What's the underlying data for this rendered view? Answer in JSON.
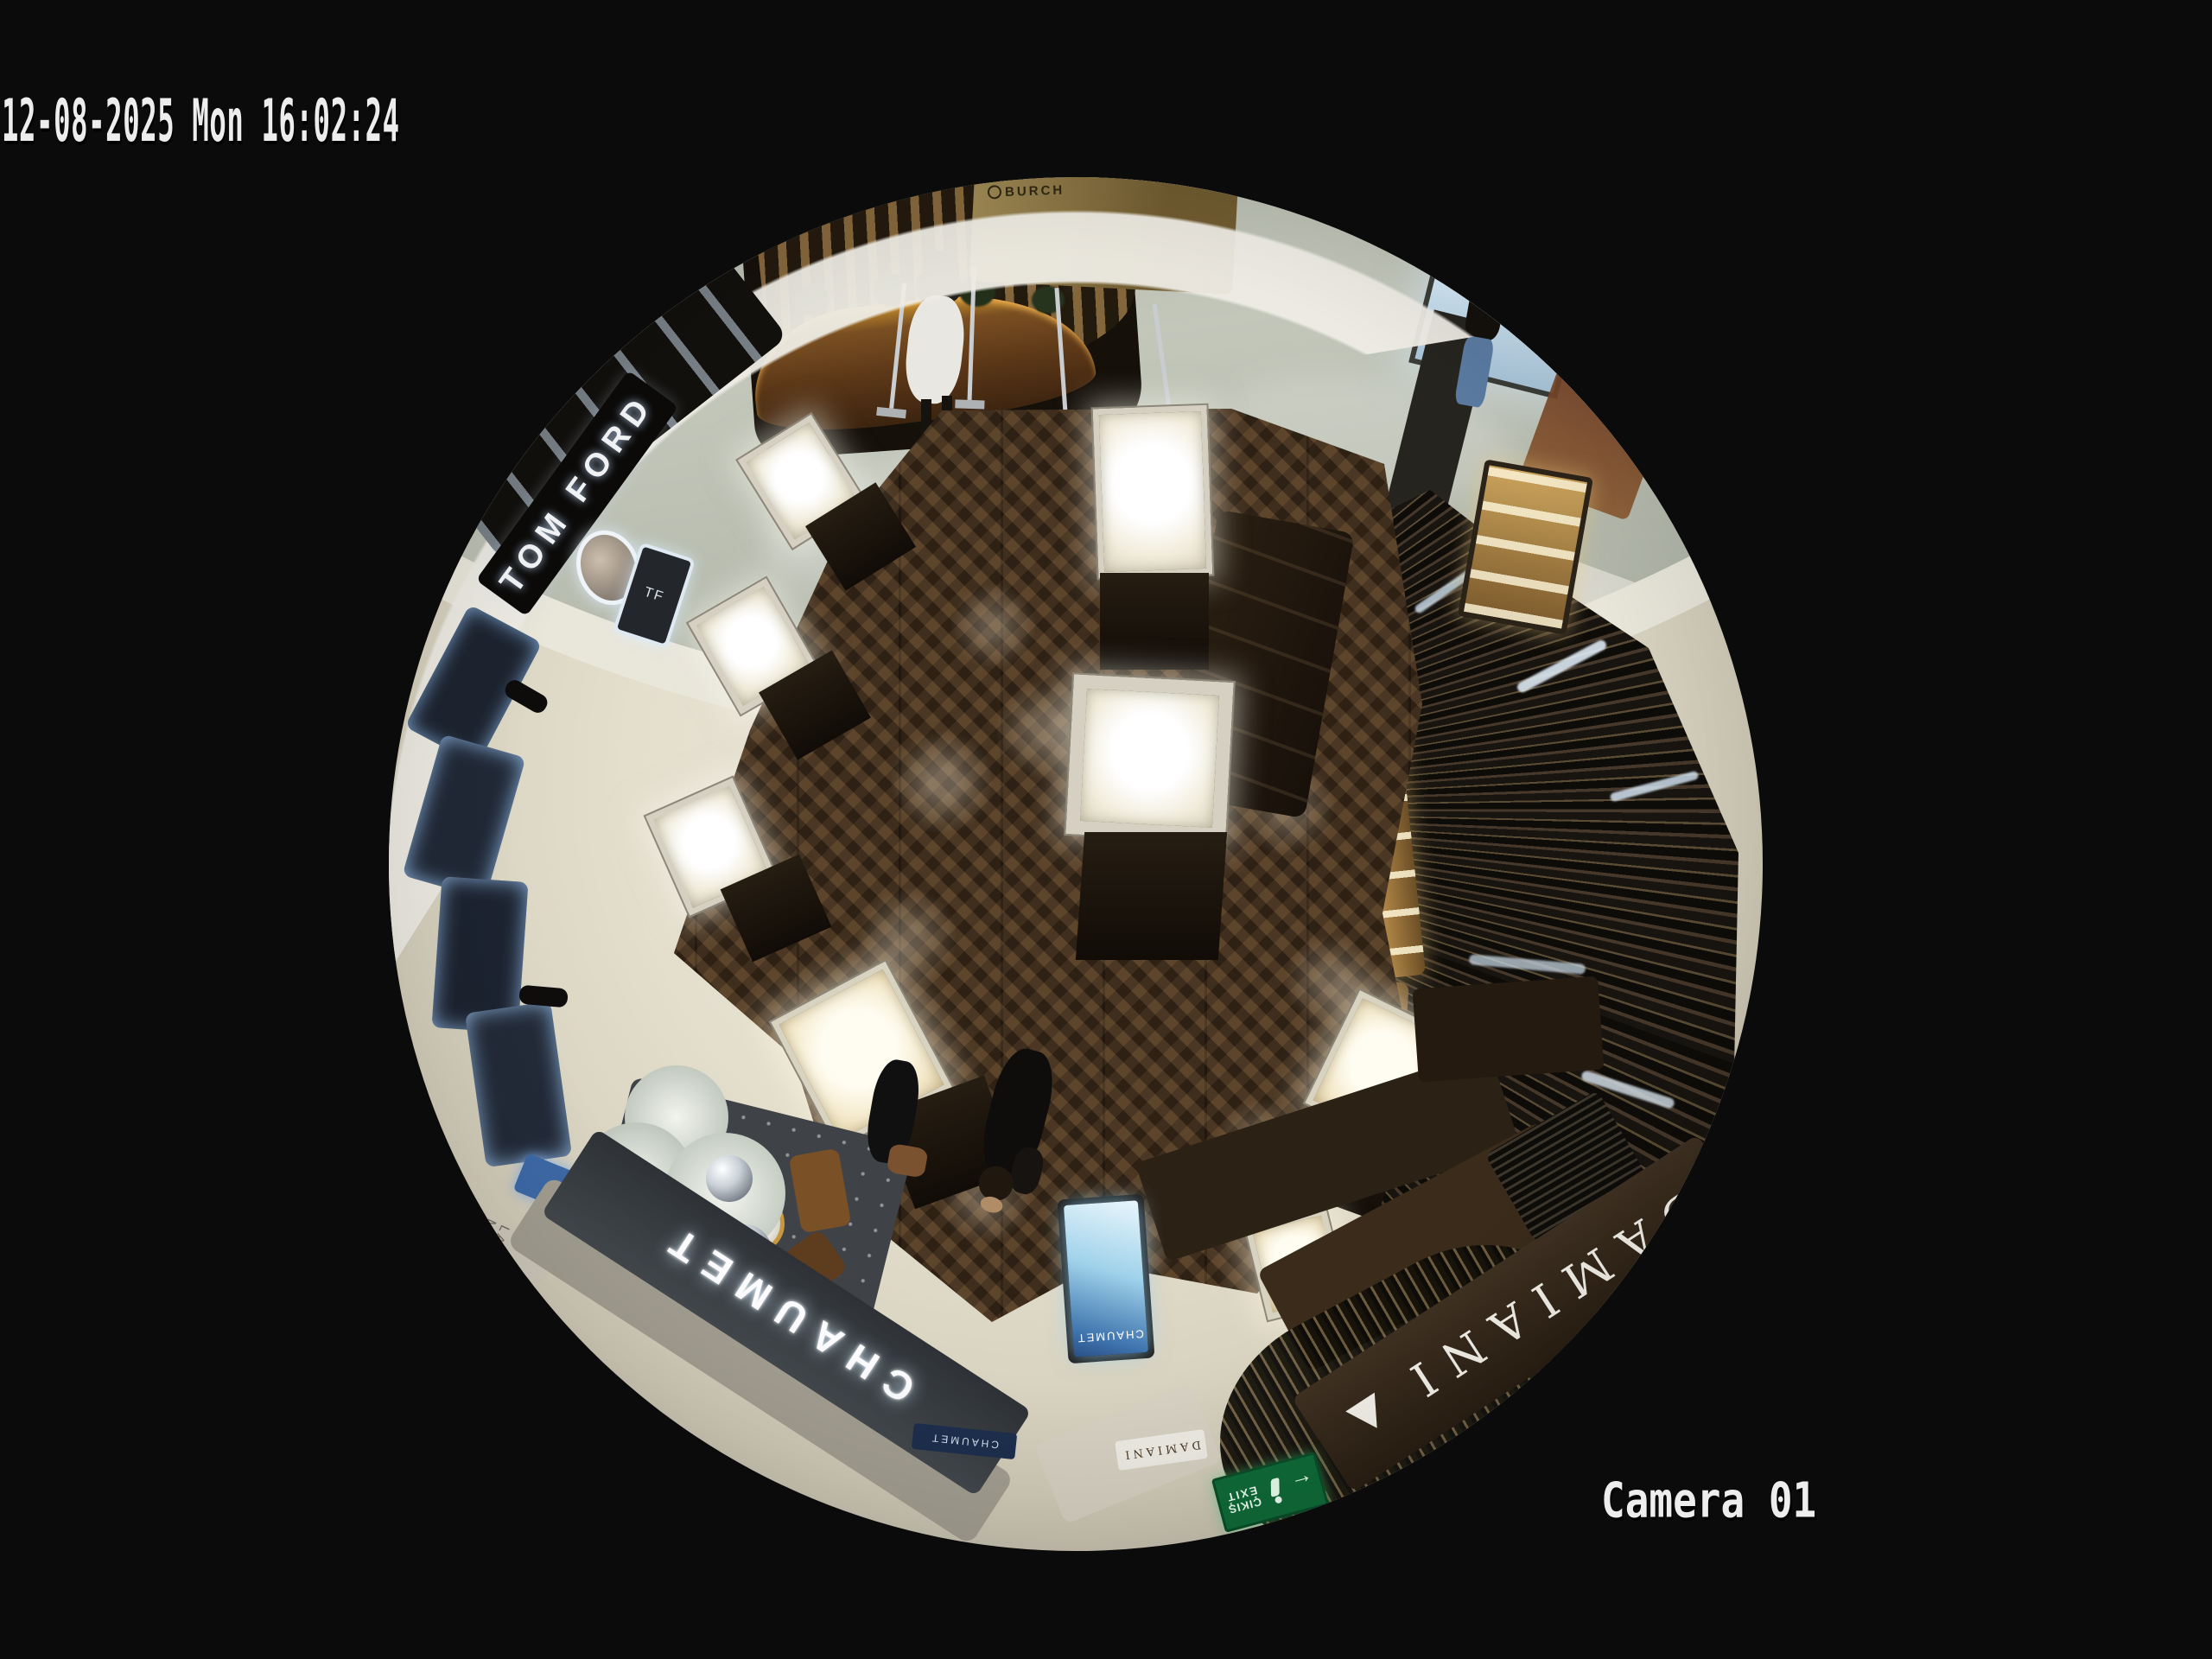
{
  "osd": {
    "timestamp": "12-08-2025 Mon 16:02:24",
    "camera_label": "Camera 01"
  },
  "scene": {
    "signs": {
      "kiosk_fascia": "BURCH",
      "tom_ford": "TOM FORD",
      "tf_screen": "TF",
      "la_mer": "LA MER",
      "chaumet_main": "CHAUMET",
      "chaumet_sub": "CHAUMET",
      "chaumet_screen": "CHAUMET",
      "damiani_main": "DAMIANI",
      "damiani_door": "DAMIANI",
      "exit_line1": "ÇIKIŞ",
      "exit_line2": "EXIT"
    },
    "colors": {
      "background": "#0b0b0b",
      "osd_text": "#ededed",
      "wood_floor": "#40301f",
      "store_marble": "#e4decd",
      "mall_marble": "#aab0a4",
      "threshold_band": "#e9e6da",
      "chaumet_fascia": "#34383d",
      "damiani_fascia": "#32261a",
      "exit_green": "#0f6b38",
      "screen_blue": "#8fc6e8",
      "slat_wall": "#2a2318",
      "kiosk_wood": "#7a5a32",
      "tree_silver": "#dfe4dc",
      "gold_shelves": "#c8a35c"
    }
  }
}
